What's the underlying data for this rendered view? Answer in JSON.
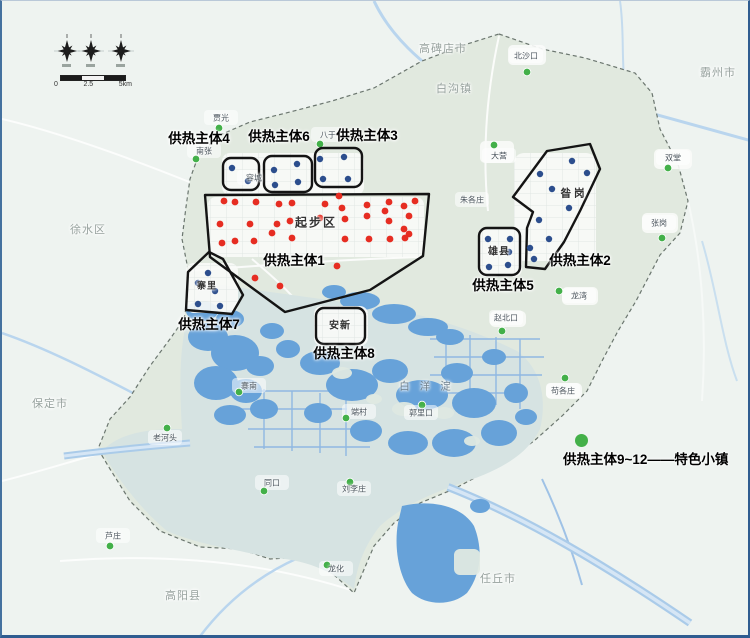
{
  "colors": {
    "red_dot": "#e62d22",
    "blue_dot": "#2c4e8d",
    "green_dot": "#43b049",
    "zone_outline": "#141414",
    "legend_green": "#43b049"
  },
  "legend": {
    "text": "供热主体9~12——特色小镇"
  },
  "compass": {
    "scale_labels": [
      "0",
      "2.5",
      "5km"
    ]
  },
  "map": {
    "lake_label": {
      "text": "白洋淀",
      "x": 428,
      "y": 385
    },
    "region_labels": [
      {
        "text": "高碑店市",
        "x": 441,
        "y": 47
      },
      {
        "text": "白沟镇",
        "x": 452,
        "y": 87
      },
      {
        "text": "霸州市",
        "x": 716,
        "y": 71
      },
      {
        "text": "徐水区",
        "x": 86,
        "y": 228
      },
      {
        "text": "保定市",
        "x": 48,
        "y": 402
      },
      {
        "text": "高阳县",
        "x": 181,
        "y": 594
      },
      {
        "text": "任丘市",
        "x": 496,
        "y": 577
      }
    ],
    "places": [
      {
        "name": "贾光",
        "label": [
          219,
          117
        ],
        "dot": [
          217,
          127
        ]
      },
      {
        "name": "北沙口",
        "label": [
          524,
          55
        ],
        "dot": [
          525,
          71
        ]
      },
      {
        "name": "南张",
        "label": [
          202,
          150
        ],
        "dot": [
          194,
          158
        ]
      },
      {
        "name": "八于",
        "label": [
          326,
          134
        ],
        "dot": [
          318,
          143
        ]
      },
      {
        "name": "容城",
        "label": [
          252,
          177
        ],
        "dot": null
      },
      {
        "name": "大营",
        "label": [
          497,
          155
        ],
        "dot": [
          492,
          144
        ]
      },
      {
        "name": "双堂",
        "label": [
          671,
          157
        ],
        "dot": [
          666,
          167
        ]
      },
      {
        "name": "朱各庄",
        "label": [
          470,
          199
        ],
        "dot": null
      },
      {
        "name": "张岗",
        "label": [
          657,
          222
        ],
        "dot": [
          660,
          237
        ]
      },
      {
        "name": "龙湾",
        "label": [
          577,
          295
        ],
        "dot": [
          557,
          290
        ]
      },
      {
        "name": "赵北口",
        "label": [
          504,
          317
        ],
        "dot": [
          500,
          330
        ]
      },
      {
        "name": "苟各庄",
        "label": [
          561,
          390
        ],
        "dot": [
          563,
          377
        ]
      },
      {
        "name": "端村",
        "label": [
          357,
          411
        ],
        "dot": [
          344,
          417
        ]
      },
      {
        "name": "郭里口",
        "label": [
          419,
          412
        ],
        "dot": [
          420,
          404
        ]
      },
      {
        "name": "寨南",
        "label": [
          247,
          385
        ],
        "dot": [
          237,
          391
        ]
      },
      {
        "name": "同口",
        "label": [
          270,
          482
        ],
        "dot": [
          262,
          490
        ]
      },
      {
        "name": "刘李庄",
        "label": [
          352,
          488
        ],
        "dot": [
          348,
          481
        ]
      },
      {
        "name": "老河头",
        "label": [
          163,
          437
        ],
        "dot": [
          165,
          427
        ]
      },
      {
        "name": "芦庄",
        "label": [
          111,
          535
        ],
        "dot": [
          108,
          545
        ]
      },
      {
        "name": "龙化",
        "label": [
          334,
          568
        ],
        "dot": [
          325,
          564
        ]
      }
    ],
    "zones": [
      {
        "id": 1,
        "label": "供热主体1",
        "label_pos": [
          292,
          258
        ],
        "inner_label": {
          "text": "起步区",
          "pos": [
            314,
            221
          ],
          "size": 12,
          "spacing": 2
        },
        "shape": {
          "type": "polygon",
          "points": [
            [
              203,
              194
            ],
            [
              427,
              193
            ],
            [
              421,
              255
            ],
            [
              368,
              289
            ],
            [
              283,
              311
            ],
            [
              208,
              256
            ]
          ]
        },
        "dot_color": "red",
        "dots": [
          [
            222,
            200
          ],
          [
            233,
            201
          ],
          [
            254,
            201
          ],
          [
            277,
            203
          ],
          [
            290,
            202
          ],
          [
            323,
            203
          ],
          [
            337,
            195
          ],
          [
            340,
            207
          ],
          [
            365,
            204
          ],
          [
            383,
            210
          ],
          [
            387,
            201
          ],
          [
            402,
            205
          ],
          [
            407,
            215
          ],
          [
            413,
            200
          ],
          [
            218,
            223
          ],
          [
            248,
            223
          ],
          [
            275,
            223
          ],
          [
            288,
            220
          ],
          [
            318,
            217
          ],
          [
            343,
            218
          ],
          [
            365,
            215
          ],
          [
            387,
            220
          ],
          [
            402,
            228
          ],
          [
            407,
            233
          ],
          [
            220,
            242
          ],
          [
            233,
            240
          ],
          [
            252,
            240
          ],
          [
            270,
            232
          ],
          [
            290,
            237
          ],
          [
            343,
            238
          ],
          [
            367,
            238
          ],
          [
            388,
            238
          ],
          [
            403,
            237
          ],
          [
            253,
            277
          ],
          [
            278,
            285
          ],
          [
            335,
            265
          ]
        ]
      },
      {
        "id": 2,
        "label": "供热主体2",
        "label_pos": [
          578,
          258
        ],
        "inner_label": {
          "text": "昝岗",
          "pos": [
            572,
            192
          ],
          "size": 10.5,
          "spacing": 3
        },
        "shape": {
          "type": "polygon",
          "points": [
            [
              588,
              143
            ],
            [
              545,
              150
            ],
            [
              511,
              196
            ],
            [
              531,
              211
            ],
            [
              525,
              227
            ],
            [
              524,
              266
            ],
            [
              543,
              268
            ],
            [
              562,
              241
            ],
            [
              578,
              210
            ],
            [
              598,
              168
            ]
          ]
        },
        "dot_color": "blue",
        "dots": [
          [
            570,
            160
          ],
          [
            538,
            173
          ],
          [
            585,
            172
          ],
          [
            550,
            188
          ],
          [
            567,
            207
          ],
          [
            537,
            219
          ],
          [
            547,
            238
          ],
          [
            528,
            247
          ],
          [
            532,
            258
          ]
        ]
      },
      {
        "id": 3,
        "label": "供热主体3",
        "label_pos": [
          365,
          133
        ],
        "inner_label": null,
        "shape": {
          "type": "rect",
          "x": 313,
          "y": 147,
          "w": 47,
          "h": 39
        },
        "dot_color": "blue",
        "dots": [
          [
            318,
            158
          ],
          [
            342,
            156
          ],
          [
            321,
            178
          ],
          [
            346,
            178
          ]
        ]
      },
      {
        "id": 4,
        "label": "供热主体4",
        "label_pos": [
          197,
          136
        ],
        "inner_label": null,
        "shape": {
          "type": "rect",
          "x": 221,
          "y": 157,
          "w": 36,
          "h": 32
        },
        "dot_color": "blue",
        "dots": [
          [
            230,
            167
          ],
          [
            246,
            180
          ]
        ]
      },
      {
        "id": 5,
        "label": "供热主体5",
        "label_pos": [
          501,
          283
        ],
        "inner_label": {
          "text": "雄县",
          "pos": [
            497,
            249
          ],
          "size": 10,
          "spacing": 1
        },
        "shape": {
          "type": "rect",
          "x": 477,
          "y": 227,
          "w": 41,
          "h": 47
        },
        "dot_color": "blue",
        "dots": [
          [
            486,
            238
          ],
          [
            508,
            238
          ],
          [
            487,
            266
          ],
          [
            506,
            264
          ],
          [
            507,
            251
          ]
        ]
      },
      {
        "id": 6,
        "label": "供热主体6",
        "label_pos": [
          277,
          134
        ],
        "inner_label": null,
        "shape": {
          "type": "rect",
          "x": 262,
          "y": 155,
          "w": 48,
          "h": 36
        },
        "dot_color": "blue",
        "dots": [
          [
            272,
            169
          ],
          [
            295,
            163
          ],
          [
            273,
            184
          ],
          [
            296,
            181
          ]
        ]
      },
      {
        "id": 7,
        "label": "供热主体7",
        "label_pos": [
          207,
          322
        ],
        "inner_label": {
          "text": "寨里",
          "pos": [
            205,
            284
          ],
          "size": 9,
          "spacing": 1
        },
        "shape": {
          "type": "polygon",
          "points": [
            [
              207,
              251
            ],
            [
              186,
              271
            ],
            [
              184,
              309
            ],
            [
              230,
              313
            ],
            [
              241,
              294
            ],
            [
              221,
              258
            ]
          ]
        },
        "dot_color": "blue",
        "dots": [
          [
            196,
            282
          ],
          [
            213,
            290
          ],
          [
            196,
            303
          ],
          [
            218,
            305
          ],
          [
            206,
            272
          ]
        ]
      },
      {
        "id": 8,
        "label": "供热主体8",
        "label_pos": [
          342,
          351
        ],
        "inner_label": {
          "text": "安新",
          "pos": [
            338,
            323
          ],
          "size": 10,
          "spacing": 1
        },
        "shape": {
          "type": "rect",
          "x": 314,
          "y": 307,
          "w": 49,
          "h": 36
        },
        "dot_color": "blue",
        "dots": []
      }
    ]
  }
}
